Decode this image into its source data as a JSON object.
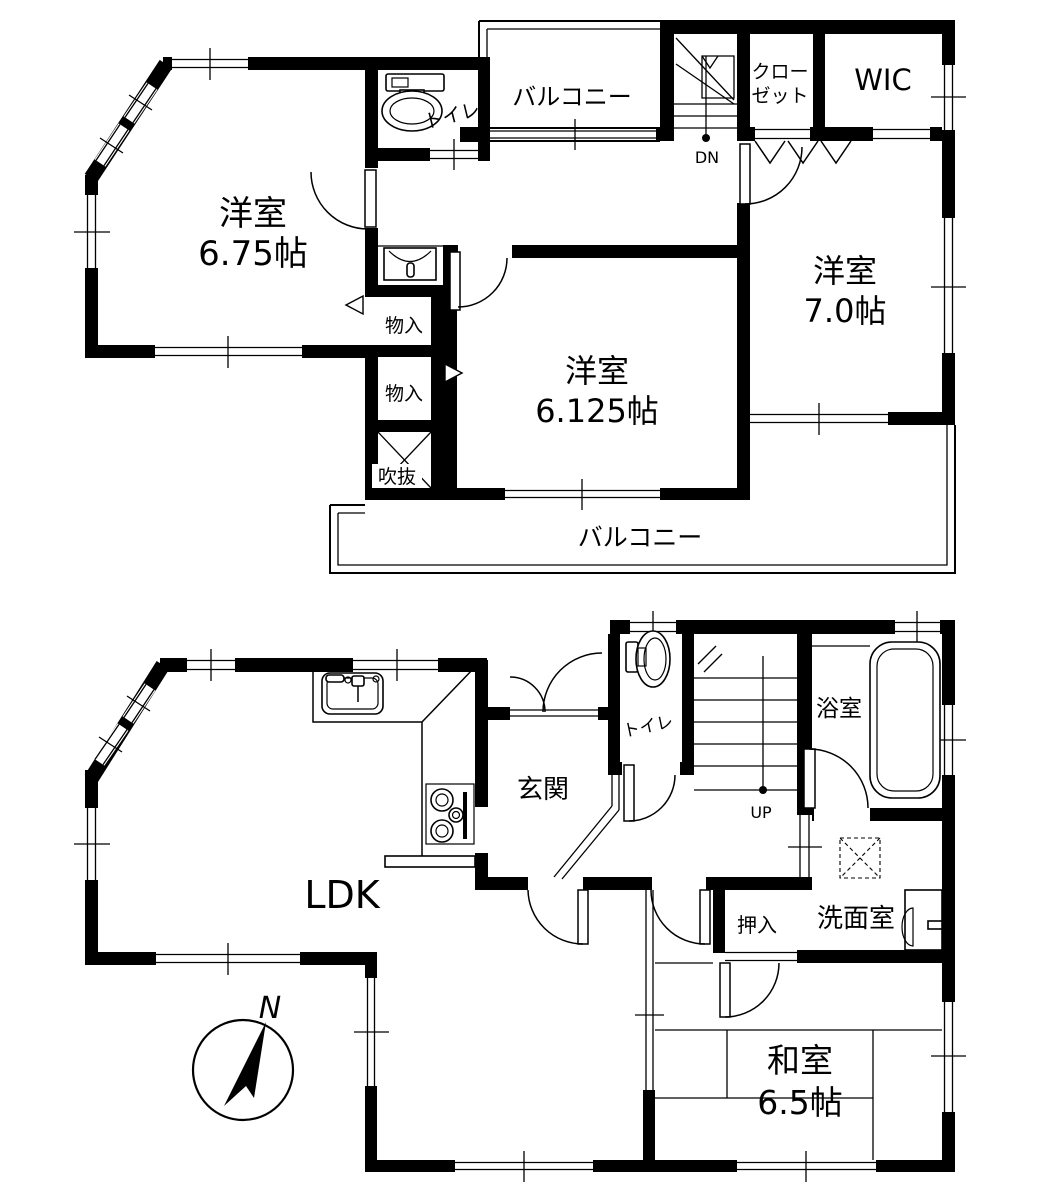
{
  "colors": {
    "wall": "#000000",
    "background": "#ffffff"
  },
  "floor2": {
    "room1_name": "洋室",
    "room1_size": "6.75帖",
    "toilet": "トイレ",
    "balcony_top": "バルコニー",
    "stairs_dn": "DN",
    "closet_l1": "クロー",
    "closet_l2": "ゼット",
    "wic": "WIC",
    "room2_name": "洋室",
    "room2_size": "7.0帖",
    "storage1": "物入",
    "storage2": "物入",
    "void": "吹抜",
    "room3_name": "洋室",
    "room3_size": "6.125帖",
    "balcony_bottom": "バルコニー"
  },
  "floor1": {
    "toilet": "トイレ",
    "stairs_up": "UP",
    "bath": "浴室",
    "entrance": "玄関",
    "washroom": "洗面室",
    "oshiire": "押入",
    "ldk": "LDK",
    "room_name": "和室",
    "room_size": "6.5帖",
    "compass_north": "N"
  }
}
